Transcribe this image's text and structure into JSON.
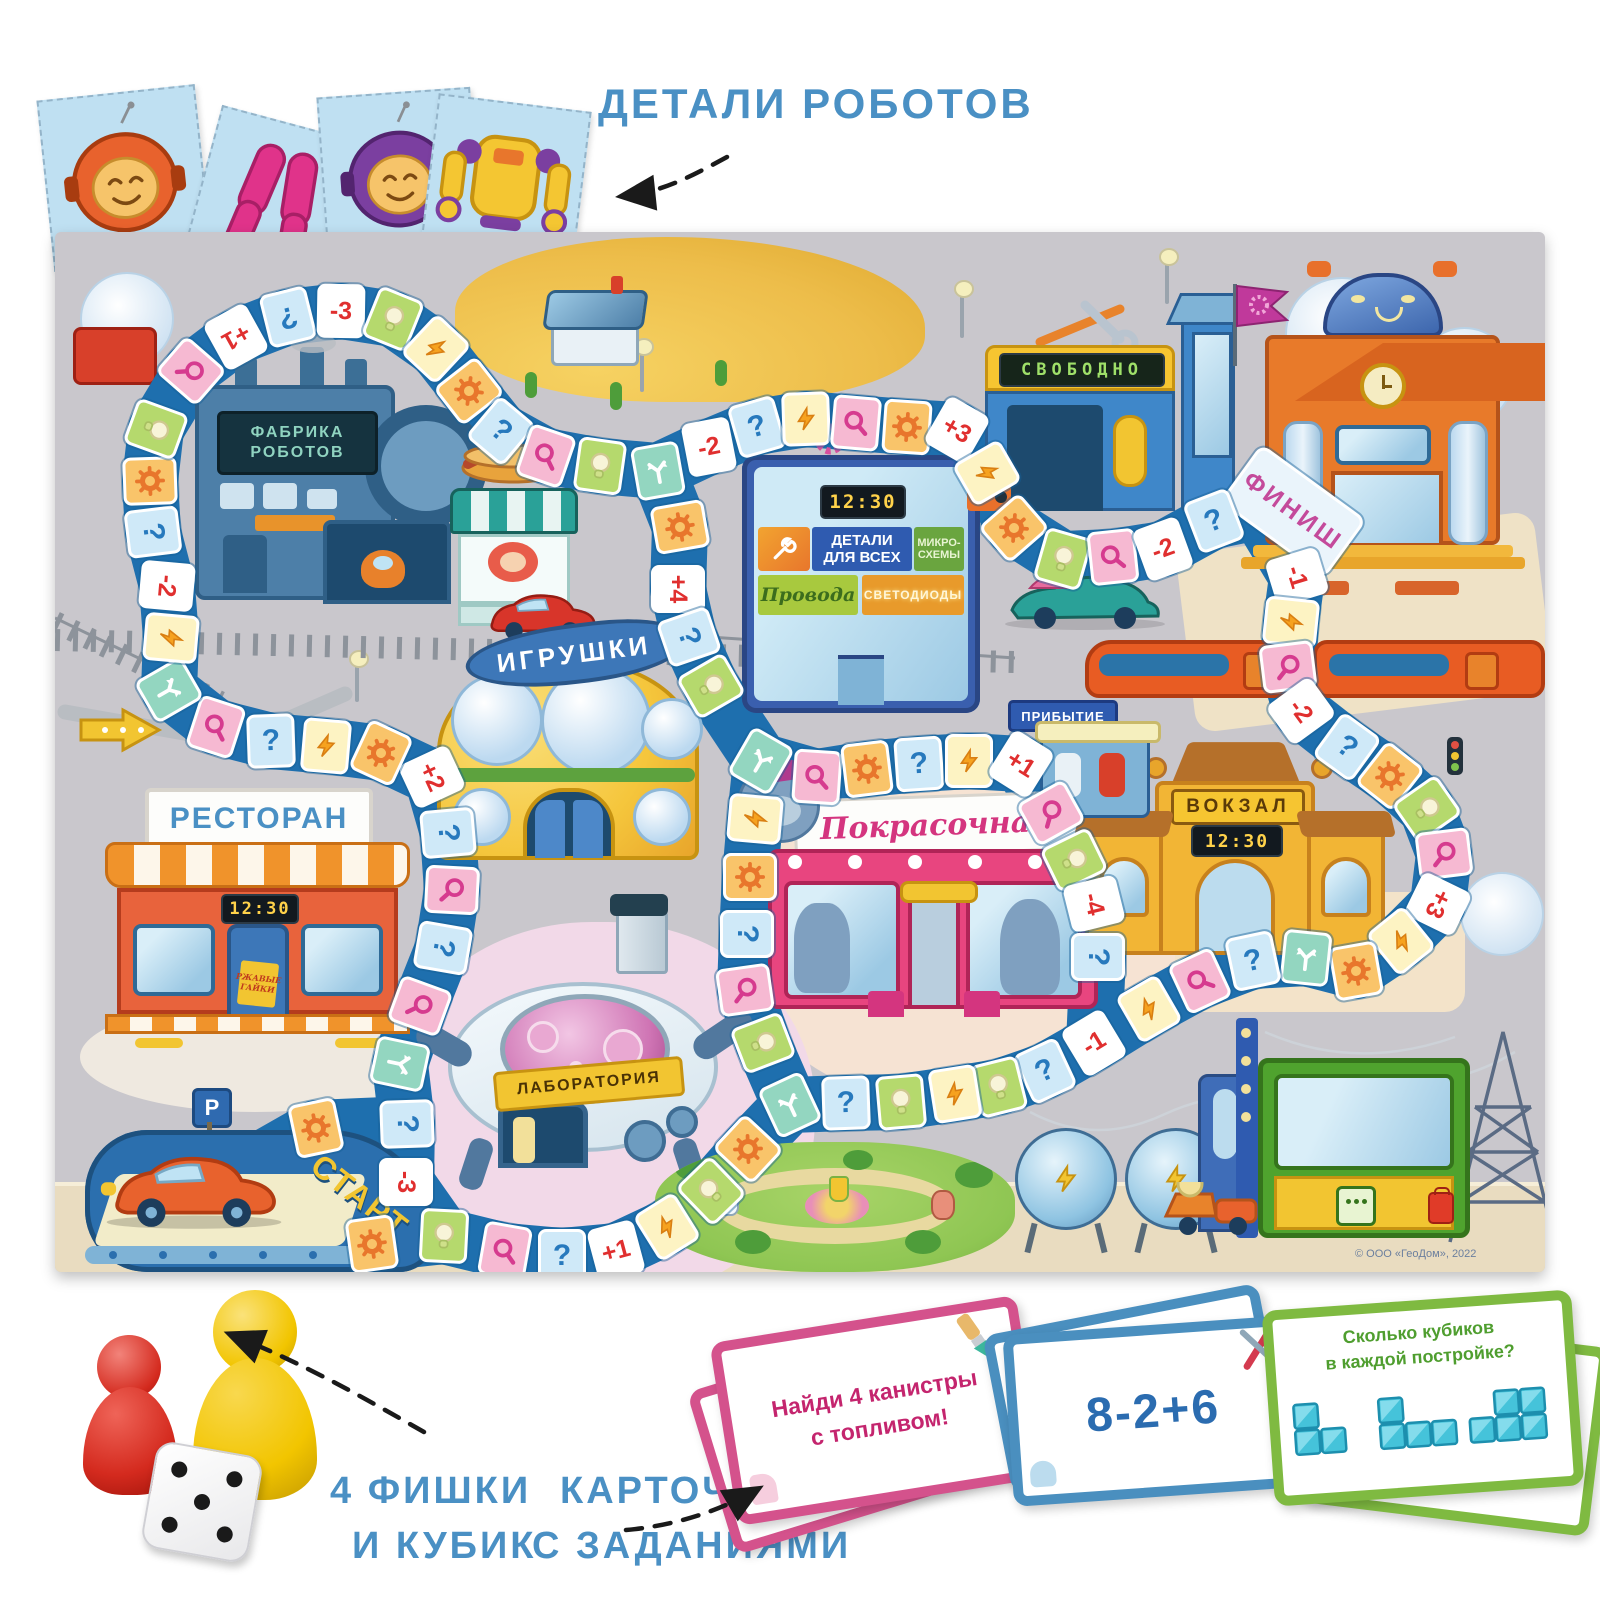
{
  "title": "ДЕТАЛИ РОБОТОВ",
  "captions": {
    "pieces1": "4 ФИШКИ",
    "pieces2": "И КУБИК",
    "cards1": "КАРТОЧКИ",
    "cards2": "С ЗАДАНИЯМИ"
  },
  "board": {
    "copyright": "© ООО «ГеоДом», 2022",
    "start_label": "СТАРТ",
    "finish_label": "ФИНИШ",
    "factory": {
      "line1": "ФАБРИКА",
      "line2": "РОБОТОВ"
    },
    "toy_store": "ИГРУШКИ",
    "restaurant": {
      "name": "РЕСТОРАН",
      "clock": "12:30",
      "poster": "РЖАВЫЕ ГАЙКИ"
    },
    "lab": "ЛАБОРАТОРИЯ",
    "paint_shop": "Покрасочная",
    "station": {
      "name": "ВОКЗАЛ",
      "clock": "12:30",
      "arrival": "ПРИБЫТИЕ"
    },
    "garage": "СВОБОДНО",
    "parts_store": {
      "clock": "12:30",
      "sign_main1": "ДЕТАЛИ",
      "sign_main2": "ДЛЯ ВСЕХ",
      "sign_chips": "МИКРО-СХЕМЫ",
      "sign_wires": "Провода",
      "sign_leds": "СВЕТОДИОДЫ"
    },
    "parking": "P",
    "spaces": [
      {
        "t": "g"
      },
      {
        "t": "q"
      },
      {
        "t": "a"
      },
      {
        "t": "m"
      },
      {
        "t": "q"
      },
      {
        "t": "m"
      },
      {
        "t": "q"
      },
      {
        "t": "n",
        "v": "+2"
      },
      {
        "t": "g"
      },
      {
        "t": "z"
      },
      {
        "t": "q"
      },
      {
        "t": "m"
      },
      {
        "t": "a"
      },
      {
        "t": "z"
      },
      {
        "t": "n",
        "v": "-2"
      },
      {
        "t": "q"
      },
      {
        "t": "g"
      },
      {
        "t": "b"
      },
      {
        "t": "m"
      },
      {
        "t": "n",
        "v": "+1"
      },
      {
        "t": "q"
      },
      {
        "t": "n",
        "v": "-3"
      },
      {
        "t": "b"
      },
      {
        "t": "z"
      },
      {
        "t": "g"
      },
      {
        "t": "q"
      },
      {
        "t": "m"
      },
      {
        "t": "b"
      },
      {
        "t": "a"
      },
      {
        "t": "n",
        "v": "-2"
      },
      {
        "t": "q"
      },
      {
        "t": "z"
      },
      {
        "t": "m"
      },
      {
        "t": "g"
      },
      {
        "t": "n",
        "v": "+3"
      },
      {
        "t": "z"
      },
      {
        "t": "g"
      },
      {
        "t": "b"
      },
      {
        "t": "m"
      },
      {
        "t": "n",
        "v": "-2"
      },
      {
        "t": "q"
      },
      {
        "t": "n",
        "v": "-1"
      },
      {
        "t": "z"
      },
      {
        "t": "m"
      },
      {
        "t": "n",
        "v": "-2"
      },
      {
        "t": "q"
      },
      {
        "t": "g"
      },
      {
        "t": "b"
      },
      {
        "t": "m"
      },
      {
        "t": "n",
        "v": "+3"
      },
      {
        "t": "z"
      },
      {
        "t": "g"
      },
      {
        "t": "a"
      },
      {
        "t": "q"
      },
      {
        "t": "m"
      },
      {
        "t": "z"
      },
      {
        "t": "n",
        "v": "-1"
      },
      {
        "t": "q"
      },
      {
        "t": "b"
      },
      {
        "t": "z"
      },
      {
        "t": "b"
      },
      {
        "t": "q"
      },
      {
        "t": "a"
      },
      {
        "t": "g"
      },
      {
        "t": "b"
      },
      {
        "t": "z"
      },
      {
        "t": "n",
        "v": "+1"
      },
      {
        "t": "q"
      },
      {
        "t": "m"
      },
      {
        "t": "b"
      },
      {
        "t": "g"
      },
      {
        "t": "n",
        "v": "-3"
      },
      {
        "t": "g"
      },
      {
        "t": "n",
        "v": "+4"
      },
      {
        "t": "q"
      },
      {
        "t": "b"
      },
      {
        "t": "a"
      },
      {
        "t": "m"
      },
      {
        "t": "g"
      },
      {
        "t": "q"
      },
      {
        "t": "z"
      },
      {
        "t": "n",
        "v": "+1"
      },
      {
        "t": "m"
      },
      {
        "t": "b"
      },
      {
        "t": "n",
        "v": "-4"
      },
      {
        "t": "q"
      },
      {
        "t": "z"
      },
      {
        "t": "g"
      },
      {
        "t": "q"
      },
      {
        "t": "m"
      },
      {
        "t": "b"
      }
    ]
  },
  "components": {
    "robot_cards": [
      "robot-head-orange",
      "robot-legs-pink",
      "robot-head-purple",
      "robot-torso-yellow"
    ],
    "pieces": [
      "red-pawn",
      "yellow-pawn",
      "die"
    ],
    "task_cards": {
      "pink": {
        "line1": "Найди 4 канистры",
        "line2": "с топливом!"
      },
      "blue": {
        "text": "8-2+6"
      },
      "green": {
        "line1": "Сколько кубиков",
        "line2": "в каждой постройке?"
      }
    }
  },
  "colors": {
    "accent_blue": "#4a90c4",
    "track": "#1e6fae",
    "pink_card": "#d4528c",
    "blue_card": "#4a8fbf",
    "green_card": "#7fba41"
  }
}
